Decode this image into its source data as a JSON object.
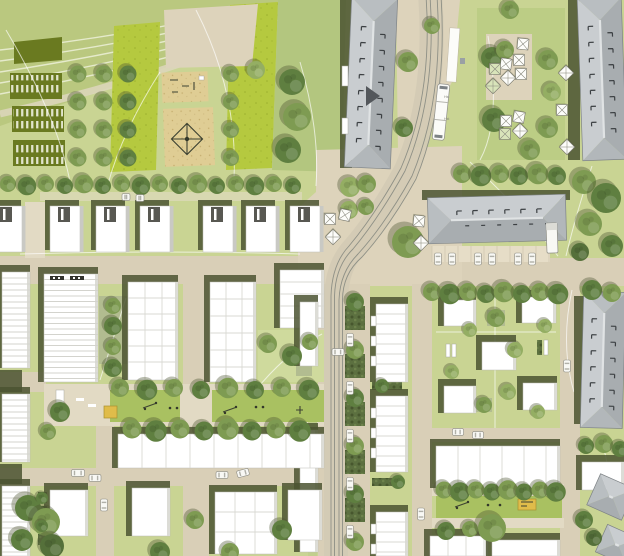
{
  "title": "Urban district masterplan site plan (aerial rendering)",
  "annotations": {
    "stop_label_top": "Hst",
    "stop_label_bottom": "Hst"
  },
  "features": {
    "allotment_gardens": "striped community garden plots",
    "orchard_grid": "grid of orchard trees",
    "playgrounds": "sand play areas with climbing net",
    "tram_line": "tram tracks curving from north into main street",
    "tram_stop": "tram stop with platform and vehicle",
    "pavilion_market": "square with tent pavilions",
    "residential_blocks": "white flat-roof housing blocks with green courtyards",
    "gable_buildings": "large gray pitched-roof buildings",
    "play_street": "green play street with sandbox and equipment"
  },
  "colors": {
    "background_grass": "#c9d493",
    "park_band": "#bac87f",
    "meadow": "#b3c67f",
    "vivid_field": "#b5c93f",
    "courtyard_green": "#cfda9d",
    "play_lawn": "#a9c161",
    "square_green": "#bccd85",
    "allotment_green": "#6a7a20",
    "road_beige": "#d9cfb7",
    "plaza_beige": "#ddd3bb",
    "path_beige": "#e2dac4",
    "sand": "#dfcd94",
    "shadow_olive": "#4b5331",
    "building_white": "#ffffff",
    "building_edge": "#c9c9c4",
    "roof_light": "#c9cdd0",
    "roof_dark": "#a8adb0",
    "roof_ridge": "#e0e3e4",
    "rail_gray": "#8e9086",
    "shrub_dark": "#5c7040",
    "tree_light": "#94ae63",
    "tree_mid": "#7e9b52",
    "tree_dark": "#5f7f40",
    "car_white": "#f8f8f4",
    "sandbox_yellow": "#e0bc4a",
    "white_path": "#ffffff"
  }
}
